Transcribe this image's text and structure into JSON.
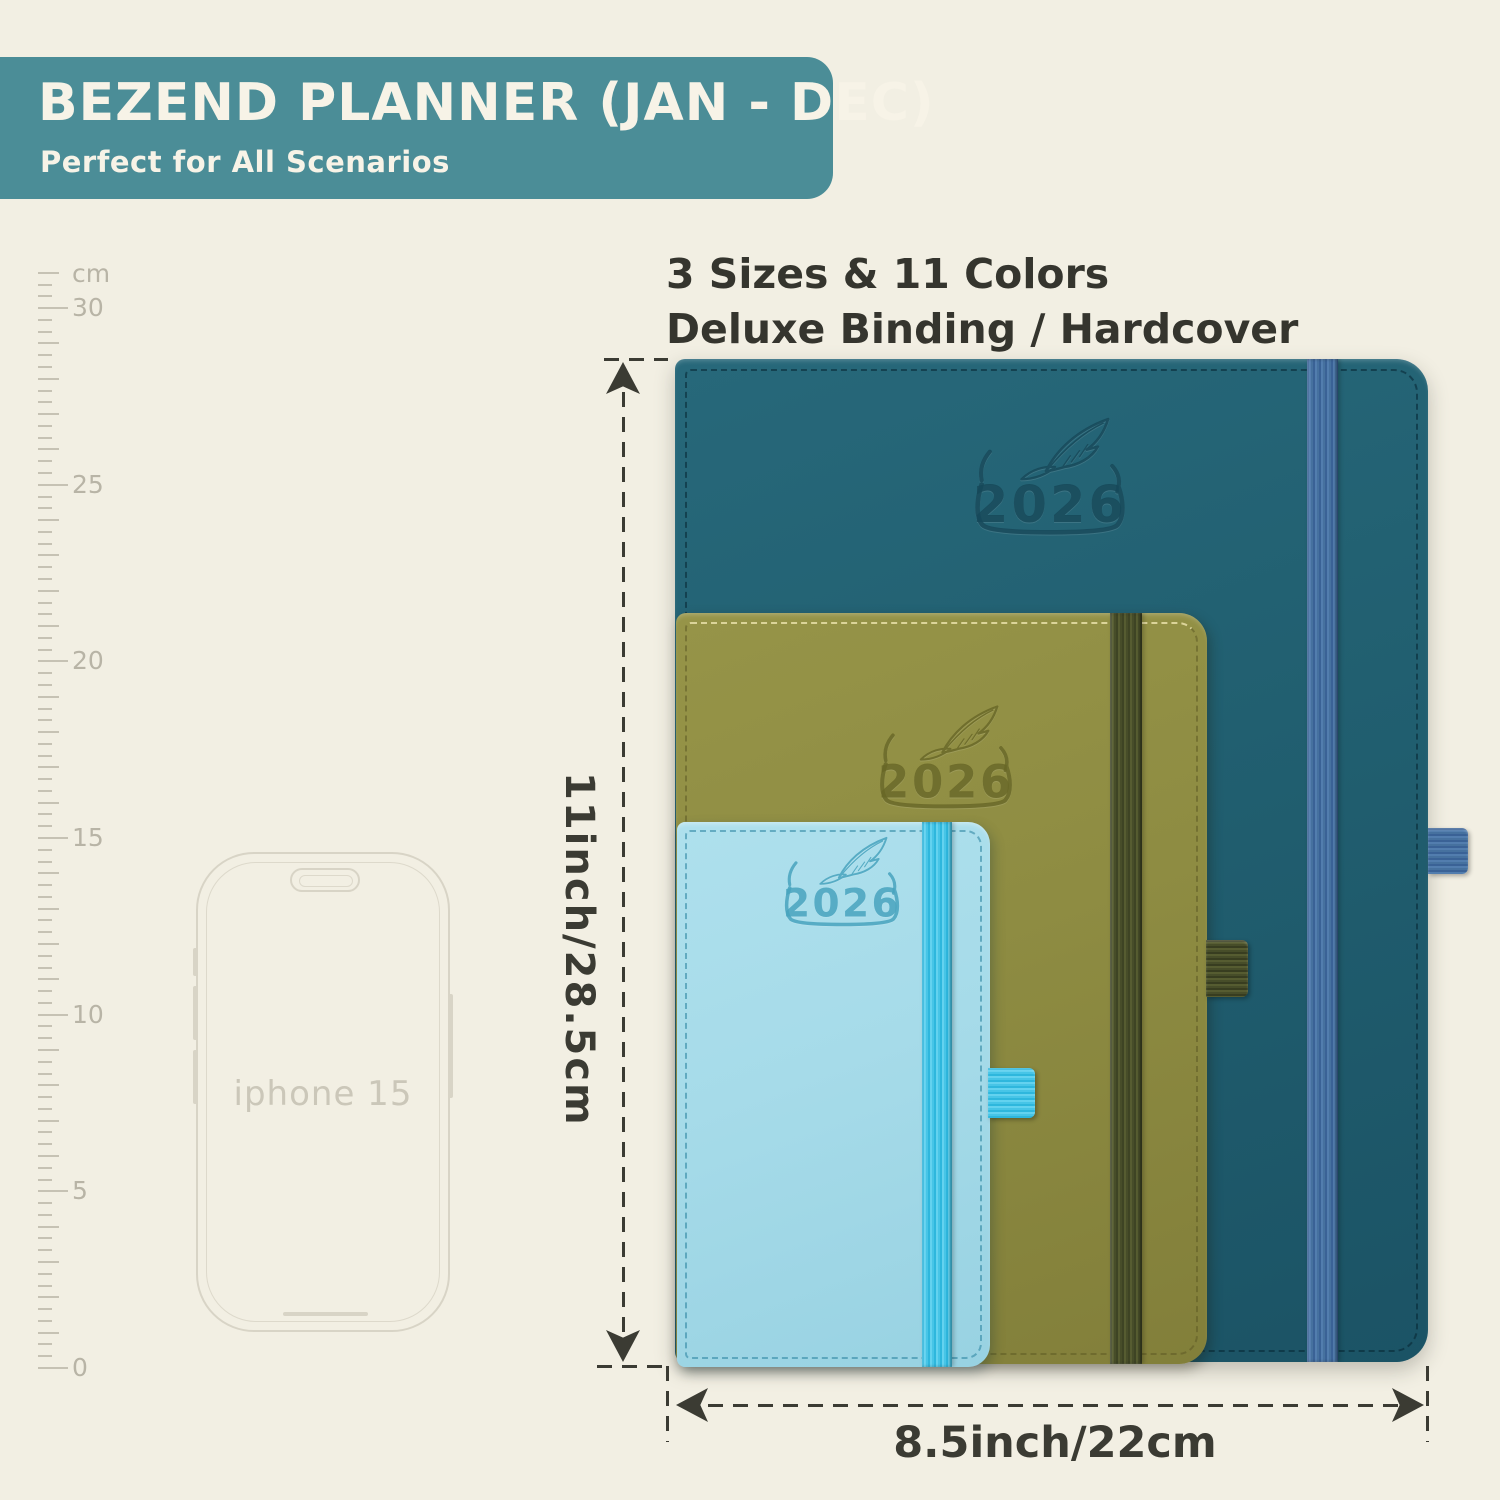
{
  "banner": {
    "title": "BEZEND PLANNER (JAN - DEC)",
    "subtitle": "Perfect for All Scenarios"
  },
  "features": {
    "line1": "3 Sizes & 11 Colors",
    "line2": "Deluxe Binding / Hardcover"
  },
  "ruler": {
    "unit": "cm",
    "labels": [
      "0",
      "5",
      "10",
      "15",
      "20",
      "25",
      "30"
    ]
  },
  "phone": {
    "label": "iphone 15"
  },
  "planners": [
    {
      "name": "large-teal-planner",
      "year": "2026",
      "cover_color": "#215f70",
      "band_color": "#4672a3",
      "emboss_color": "#17495a"
    },
    {
      "name": "medium-olive-planner",
      "year": "2026",
      "cover_color": "#8e8c42",
      "band_color": "#474d29",
      "emboss_color": "#696827"
    },
    {
      "name": "small-sky-planner",
      "year": "2026",
      "cover_color": "#a6dbe9",
      "band_color": "#47c5e7",
      "emboss_color": "#47a3be"
    }
  ],
  "dimensions": {
    "height_label": "11inch/28.5cm",
    "width_label": "8.5inch/22cm"
  },
  "colors": {
    "background": "#f2efe3",
    "banner_bg": "#4b8d97",
    "banner_text": "#f7f3e7",
    "text_dark": "#35352e",
    "annotation": "#3b3b33",
    "ruler_gray": "#c6c2b4",
    "phone_outline": "#d8d4c6"
  }
}
